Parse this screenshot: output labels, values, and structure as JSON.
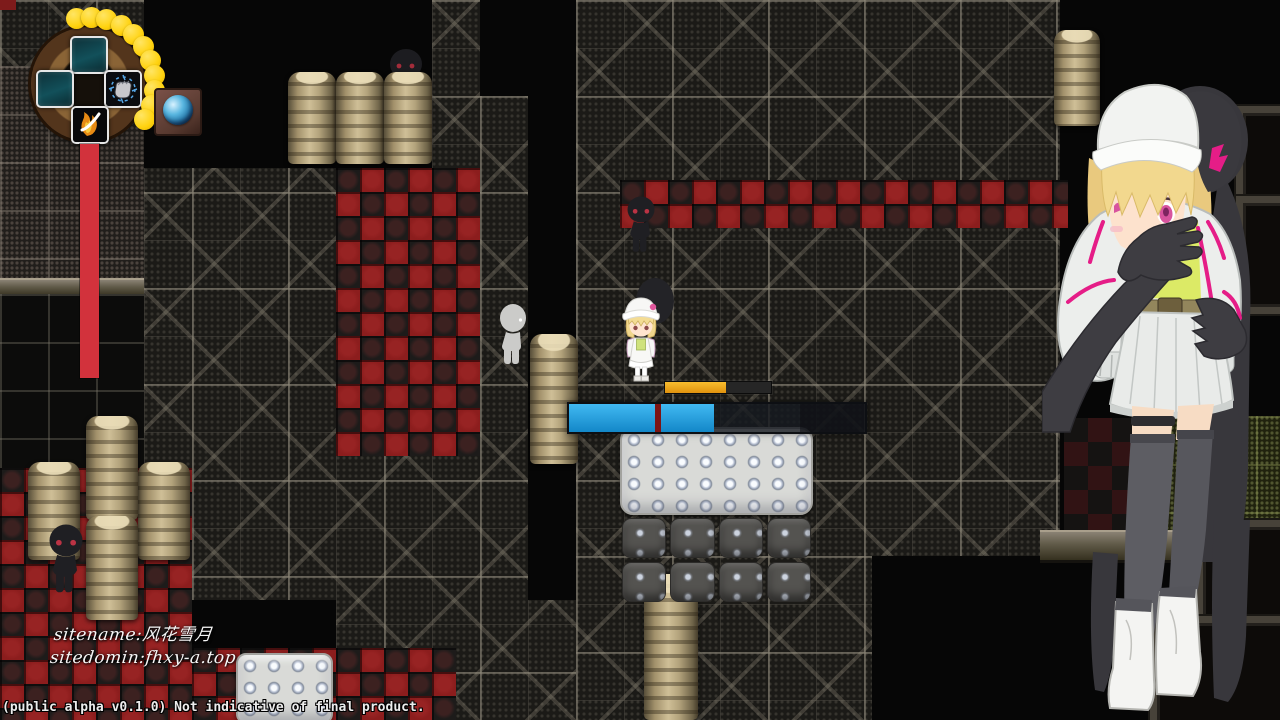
{
  "hud": {
    "skill_wheel": {
      "slots": [
        {
          "id": "up",
          "icon": "empty-slot"
        },
        {
          "id": "left",
          "icon": "empty-slot"
        },
        {
          "id": "right",
          "icon": "fist-strike-skill"
        },
        {
          "id": "down",
          "icon": "flame-dash-skill"
        }
      ],
      "charge_dots": 11,
      "dot_color": "#ffd616"
    },
    "health_bar": {
      "percent": 100,
      "color": "#d2323c"
    },
    "orb": {
      "name": "globe-orb"
    }
  },
  "combat": {
    "cast_bar": {
      "percent": 58,
      "fill_color": "",
      "track_color": "#262626"
    },
    "boss_bar": {
      "percent": 49,
      "divider_percent": 29,
      "fill_color": "",
      "divider_color": "#7c1414"
    }
  },
  "watermark": {
    "line1": "sitename:风花雪月",
    "line2": "sitedomin:fhxy-a.top"
  },
  "footer": {
    "status_text": "(public alpha v0.1.0) Not indicative of final product."
  },
  "palette": {
    "checker_red": "#8c1d1d",
    "accent_magenta": "#e51d87",
    "barrel_tan": "#c2b084",
    "hud_ring_brown": "#6e4a26"
  },
  "entities": {
    "player": "hero-girl",
    "npc": "pale-figure",
    "enemies": [
      "shadow-lurker-top",
      "shadow-lurker-mid",
      "shadow-lurker-bottom"
    ],
    "portrait": "heroine-grabbed-by-shadow"
  }
}
